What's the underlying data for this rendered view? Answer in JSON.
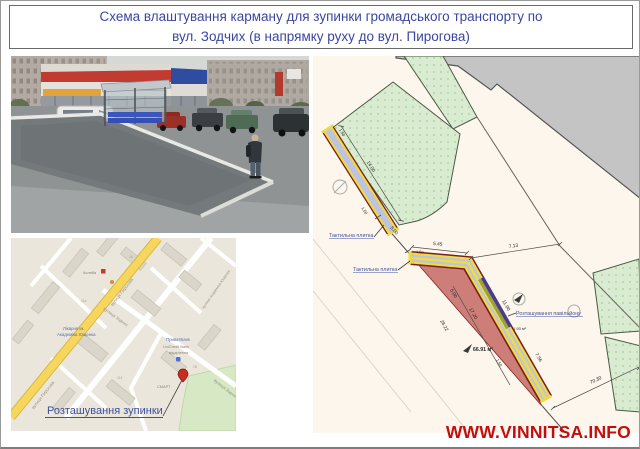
{
  "title": {
    "line1": "Схема влаштування карману для зупинки громадського транспорту по",
    "line2": "вул. Зодчих (в напрямку руху до вул. Пирогова)"
  },
  "watermark": "WWW.VINNITSA.INFO",
  "map": {
    "callout": "Розташування зупинки",
    "streets": {
      "pyrohova_a": "вулиця Пирогова",
      "pyrohova_b": "вулиця Пирогова",
      "zodchykh_a": "вулиця Зодчих",
      "zodchykh_b": "вулиця Зодчих",
      "yushchenka": "вулиця Академіка Ющенка"
    },
    "pois": {
      "kolyba": "Колиба",
      "hospital1": "Лікарня ім.",
      "hospital2": "Академіка Ющенка",
      "privatbank": "ПриватБанк",
      "unicredit": "UniCredit Bank",
      "branch": "відділення",
      "smart": "СМАРТ"
    },
    "house_numbers": {
      "n1": "16",
      "n2": "11а",
      "n3": "114",
      "n4": "28"
    }
  },
  "plan": {
    "labels": {
      "tactile_top": "Тактильна плитка",
      "tactile_bottom": "Тактильна плитка",
      "pavilion": "Розташування павільйону"
    },
    "areas": {
      "pocket": "66.91 м²",
      "pavilion": "1.93 м²"
    },
    "dims": {
      "strip_len": "14.00",
      "strip_w_top": "1.50",
      "strip_w_bot": "1.50",
      "gap": "5.00",
      "jog": "5.45",
      "jog_w": "1.50",
      "offset": "7.13",
      "inner_a": "5.00",
      "inner_b": "17.20",
      "pav_len": "11.00",
      "edge": "28.22",
      "pocket_w": "1.50",
      "right": "7.56",
      "road": "70.30"
    }
  },
  "colors": {
    "title_blue": "#3b46a0",
    "watermark_red": "#c40e0e",
    "pocket_red": "#ce7e78",
    "lawn_green": "#d9ecd2",
    "tactile_yellow": "#f0dc3c",
    "sidewalk_lavender": "#bdc4e2",
    "pavilion_purple": "#4b3b8f",
    "map_road_yellow": "#f6d65c"
  }
}
